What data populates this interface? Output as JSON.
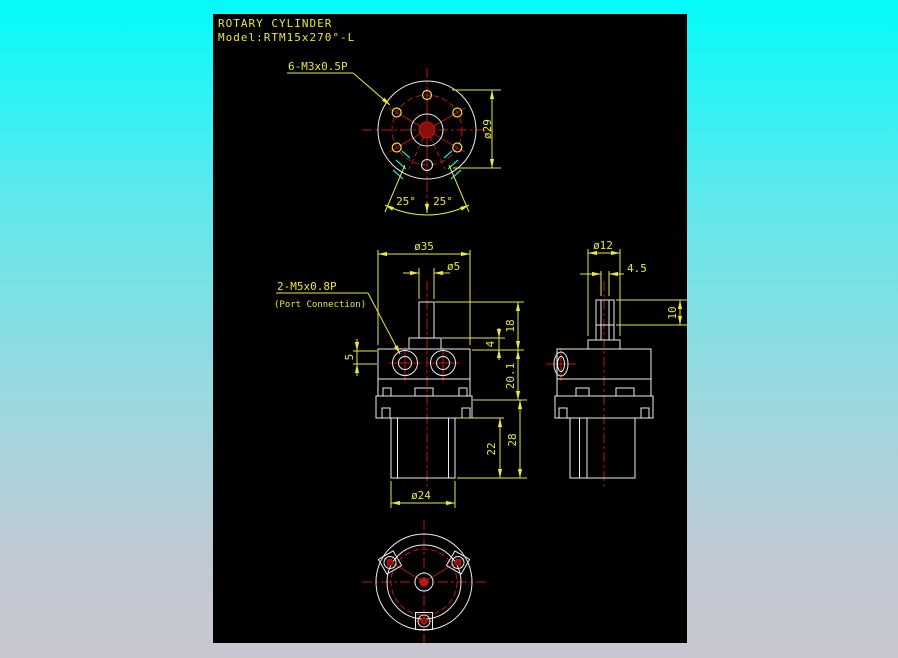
{
  "colors": {
    "background_top": "#02FBFB",
    "background_bottom": "#C8C7D0",
    "canvas": "#000000",
    "dimension_yellow": "#E8E83C",
    "geometry_white": "#EDEDED",
    "centerline_red": "#C41414",
    "hatch_cyan": "#1CDEDE"
  },
  "title": {
    "line1": "ROTARY CYLINDER",
    "line2": "Model:RTM15x270°-L"
  },
  "top_view": {
    "thread_label": "6-M3x0.5P",
    "bolt_circle_dia": "ø29",
    "angle_left": "25°",
    "angle_right": "25°"
  },
  "front_view": {
    "body_width": "ø35",
    "shaft_dia": "ø5",
    "port_label": "2-M5x0.8P",
    "port_note": "(Port Connection)",
    "port_offset": "5",
    "shaft_height": "18",
    "collar_height": "4",
    "body_height": "20.1",
    "cyl_height": "22",
    "lower_height": "28",
    "cyl_dia": "ø24"
  },
  "side_view": {
    "shaft_dia": "ø12",
    "flat_width": "4.5",
    "flat_length": "10"
  }
}
